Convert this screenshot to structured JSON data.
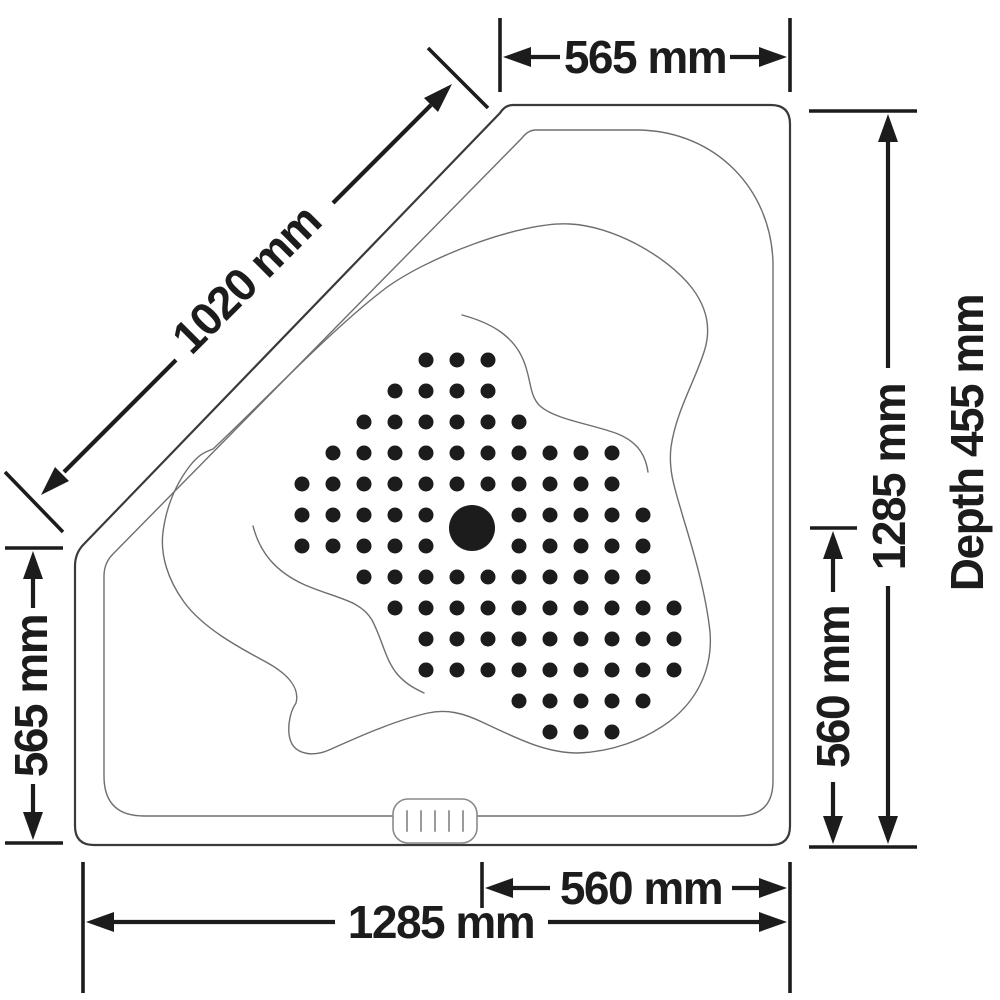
{
  "labels": {
    "top_width": "565 mm",
    "diagonal_width": "1020 mm",
    "left_height": "565 mm",
    "right_full_height": "1285 mm",
    "depth": "Depth 455 mm",
    "right_basin_height": "560 mm",
    "bottom_basin_width": "560 mm",
    "bottom_full_width": "1285 mm"
  },
  "colors": {
    "ink": "#1c1c1c",
    "outline_dark": "#3a3a3a",
    "outline_light": "#6e6e6e",
    "background": "#ffffff"
  },
  "jets": {
    "origin_x": 302,
    "origin_y": 360,
    "spacing": 31,
    "dot_radius": 7.5,
    "rows": [
      [
        4,
        5,
        6
      ],
      [
        3,
        4,
        5,
        6
      ],
      [
        2,
        3,
        4,
        5,
        6,
        7
      ],
      [
        1,
        2,
        3,
        4,
        5,
        6,
        7,
        8,
        9,
        10
      ],
      [
        0,
        1,
        2,
        3,
        4,
        5,
        6,
        7,
        8,
        9,
        10
      ],
      [
        0,
        1,
        2,
        3,
        4,
        7,
        8,
        9,
        10,
        11
      ],
      [
        0,
        1,
        2,
        3,
        4,
        7,
        8,
        9,
        10,
        11
      ],
      [
        2,
        3,
        4,
        5,
        6,
        7,
        8,
        9,
        10,
        11
      ],
      [
        3,
        4,
        5,
        6,
        7,
        8,
        9,
        10,
        11,
        12
      ],
      [
        4,
        5,
        6,
        7,
        8,
        9,
        10,
        11,
        12
      ],
      [
        4,
        5,
        6,
        7,
        8,
        9,
        10,
        11,
        12
      ],
      [
        7,
        8,
        9,
        10,
        11
      ],
      [
        8,
        9,
        10
      ]
    ],
    "drain": {
      "cx": 472,
      "cy": 528,
      "r": 23
    }
  },
  "control_panel": {
    "ticks": 5
  }
}
